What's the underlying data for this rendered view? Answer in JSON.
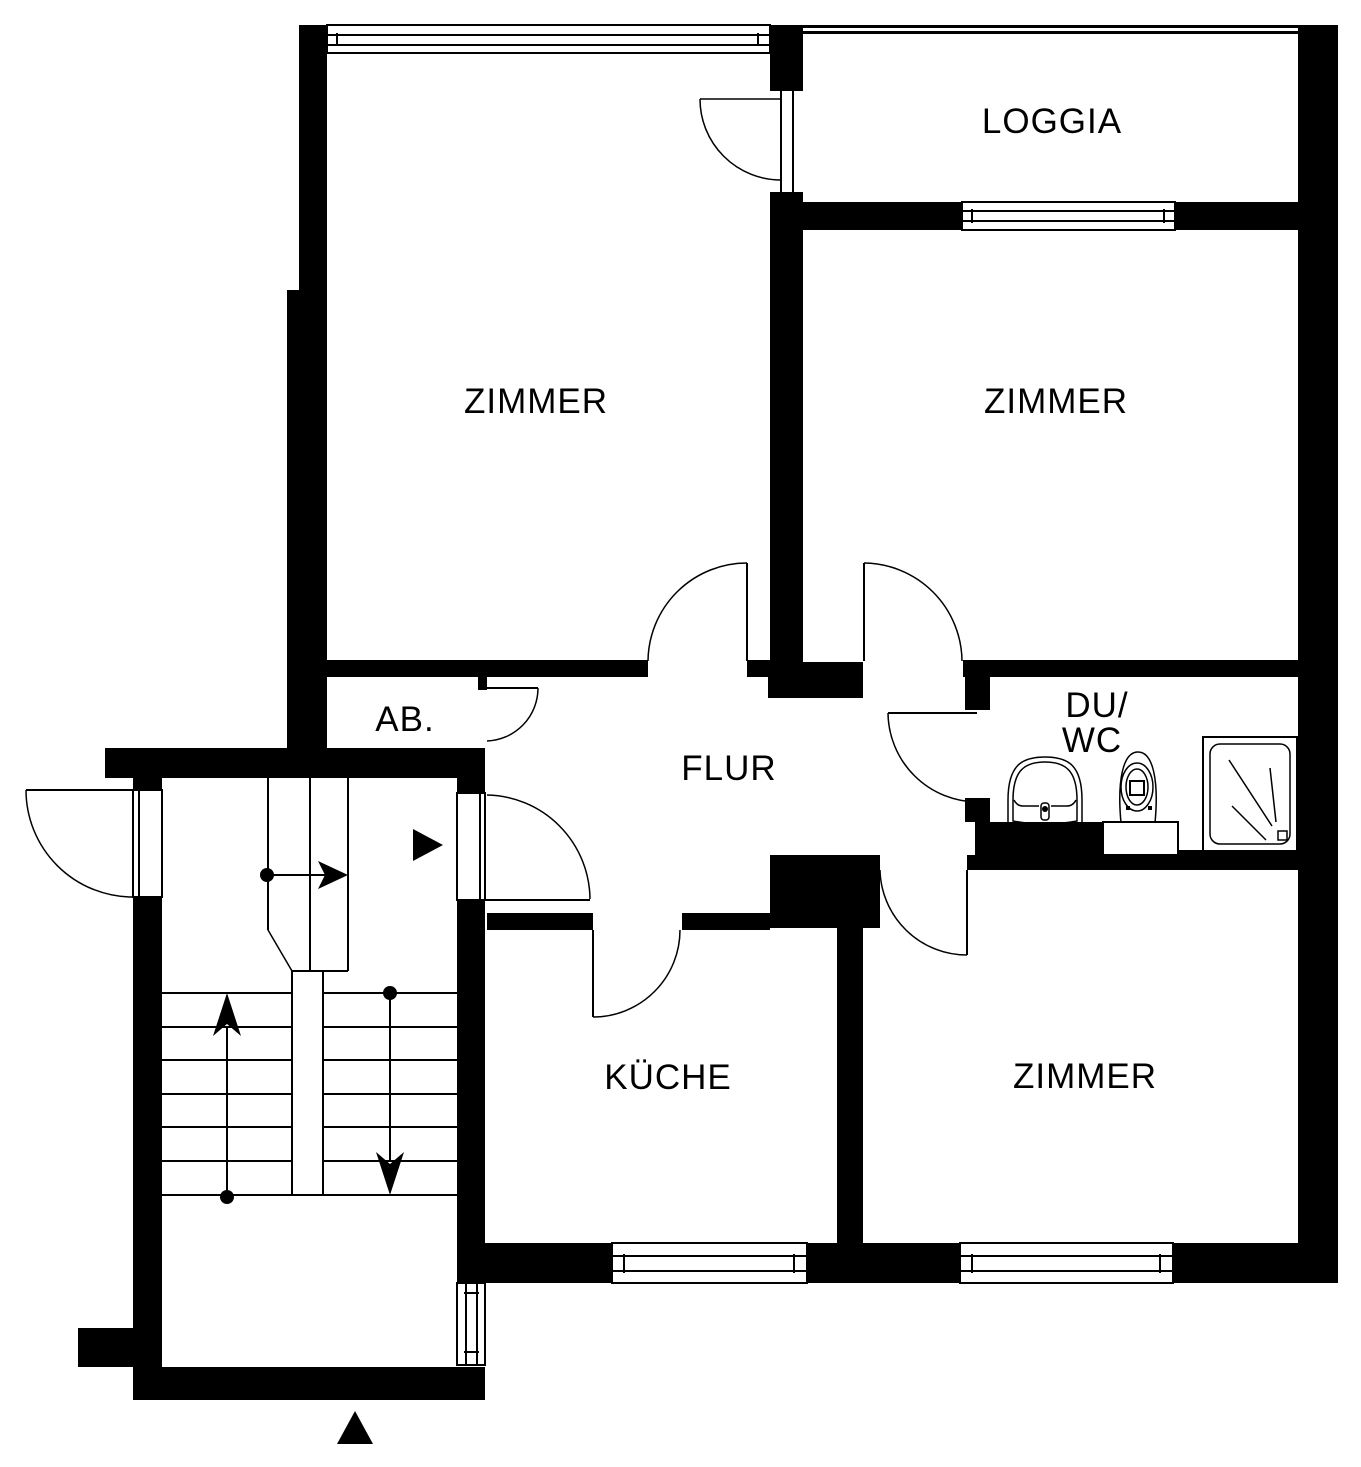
{
  "title": "Apartment floor plan",
  "labels": {
    "zimmer_top_left": "ZIMMER",
    "zimmer_top_right": "ZIMMER",
    "zimmer_bottom_right": "ZIMMER",
    "loggia": "LOGGIA",
    "flur": "FLUR",
    "storage": "AB.",
    "shower_wc_line1": "DU/",
    "shower_wc_line2": "WC",
    "kitchen": "KÜCHE"
  },
  "icons": {
    "apartment_entrance_marker": "right-solid-triangle",
    "building_entrance_marker": "up-solid-triangle",
    "stairs_up_arrow": "up-arrow",
    "stairs_down_arrow": "down-arrow",
    "landing_direction_arrow": "right-arrow"
  },
  "colors": {
    "wall": "#000000",
    "background": "#ffffff",
    "line": "#000000"
  }
}
